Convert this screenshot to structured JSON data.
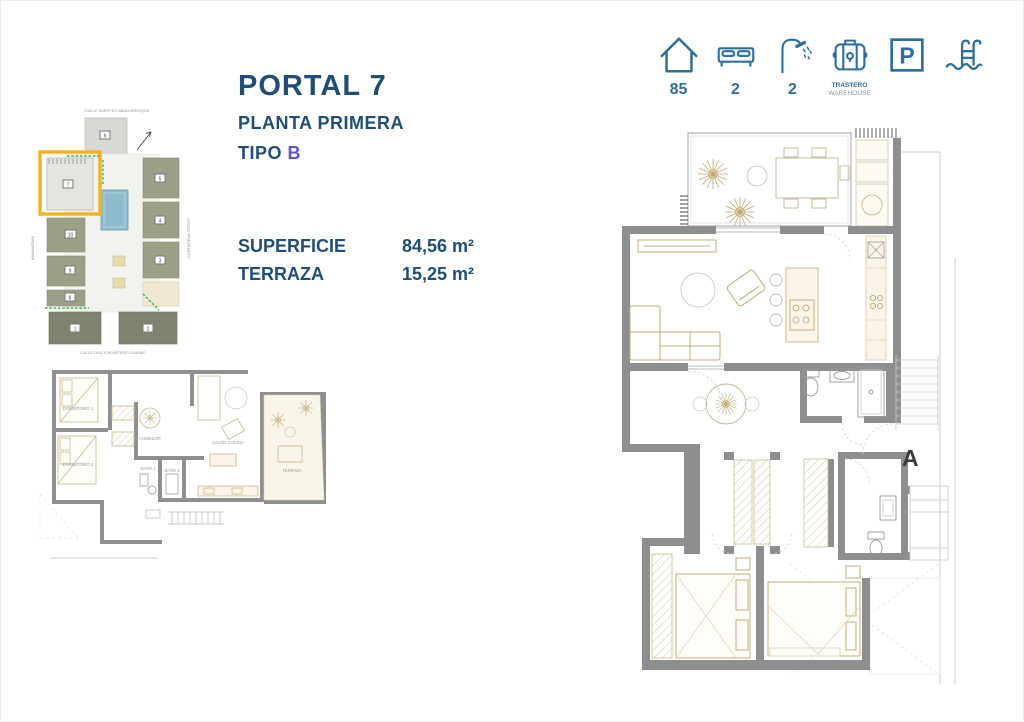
{
  "header": {
    "title": "PORTAL 7",
    "subtitle": "PLANTA PRIMERA",
    "type_label": "TIPO",
    "type_value": "B"
  },
  "measurements": {
    "rows": [
      {
        "label": "SUPERFICIE",
        "value": "84,56 m²"
      },
      {
        "label": "TERRAZA",
        "value": "15,25 m²"
      }
    ]
  },
  "amenities": {
    "items": [
      {
        "name": "house",
        "value": "85"
      },
      {
        "name": "bed",
        "value": "2"
      },
      {
        "name": "shower",
        "value": "2"
      },
      {
        "name": "storage",
        "line1": "TRASTERO",
        "line2": "WAREHOUSE"
      },
      {
        "name": "parking",
        "letter": "P"
      },
      {
        "name": "pool"
      }
    ]
  },
  "site_plan": {
    "streets": {
      "top": "CALLE SUERTES ABADORROQUE",
      "bottom": "CALLE DOCTOR ARTERO GUIRAO",
      "left": "HABANERAS",
      "right": "CARTAGENA OTROS"
    },
    "numbers": {
      "n1": "1",
      "n2": "2",
      "n3": "3",
      "n4": "4",
      "n5": "5",
      "n6": "6",
      "n7": "7",
      "n8": "8",
      "n9": "9",
      "n10": "10"
    }
  },
  "large_plan": {
    "section_label": "A"
  },
  "small_plan": {
    "labels": {
      "dorm1": "DORMITORIO 1",
      "dorm2": "DORMITORIO 2",
      "comedor": "COMEDOR",
      "salon": "SALÓN COCINA",
      "terraza": "TERRAZA",
      "bano1": "BAÑO 1",
      "bano2": "BAÑO 2"
    }
  },
  "colors": {
    "accent_blue": "#2d6f9f",
    "title_navy": "#1f4e79",
    "type_purple": "#5b55d8",
    "wall_gray": "#8e8e8e",
    "furniture_tan": "#c4ac78",
    "highlight_yellow": "#f2b31c",
    "pool_blue": "#8fbccd"
  }
}
